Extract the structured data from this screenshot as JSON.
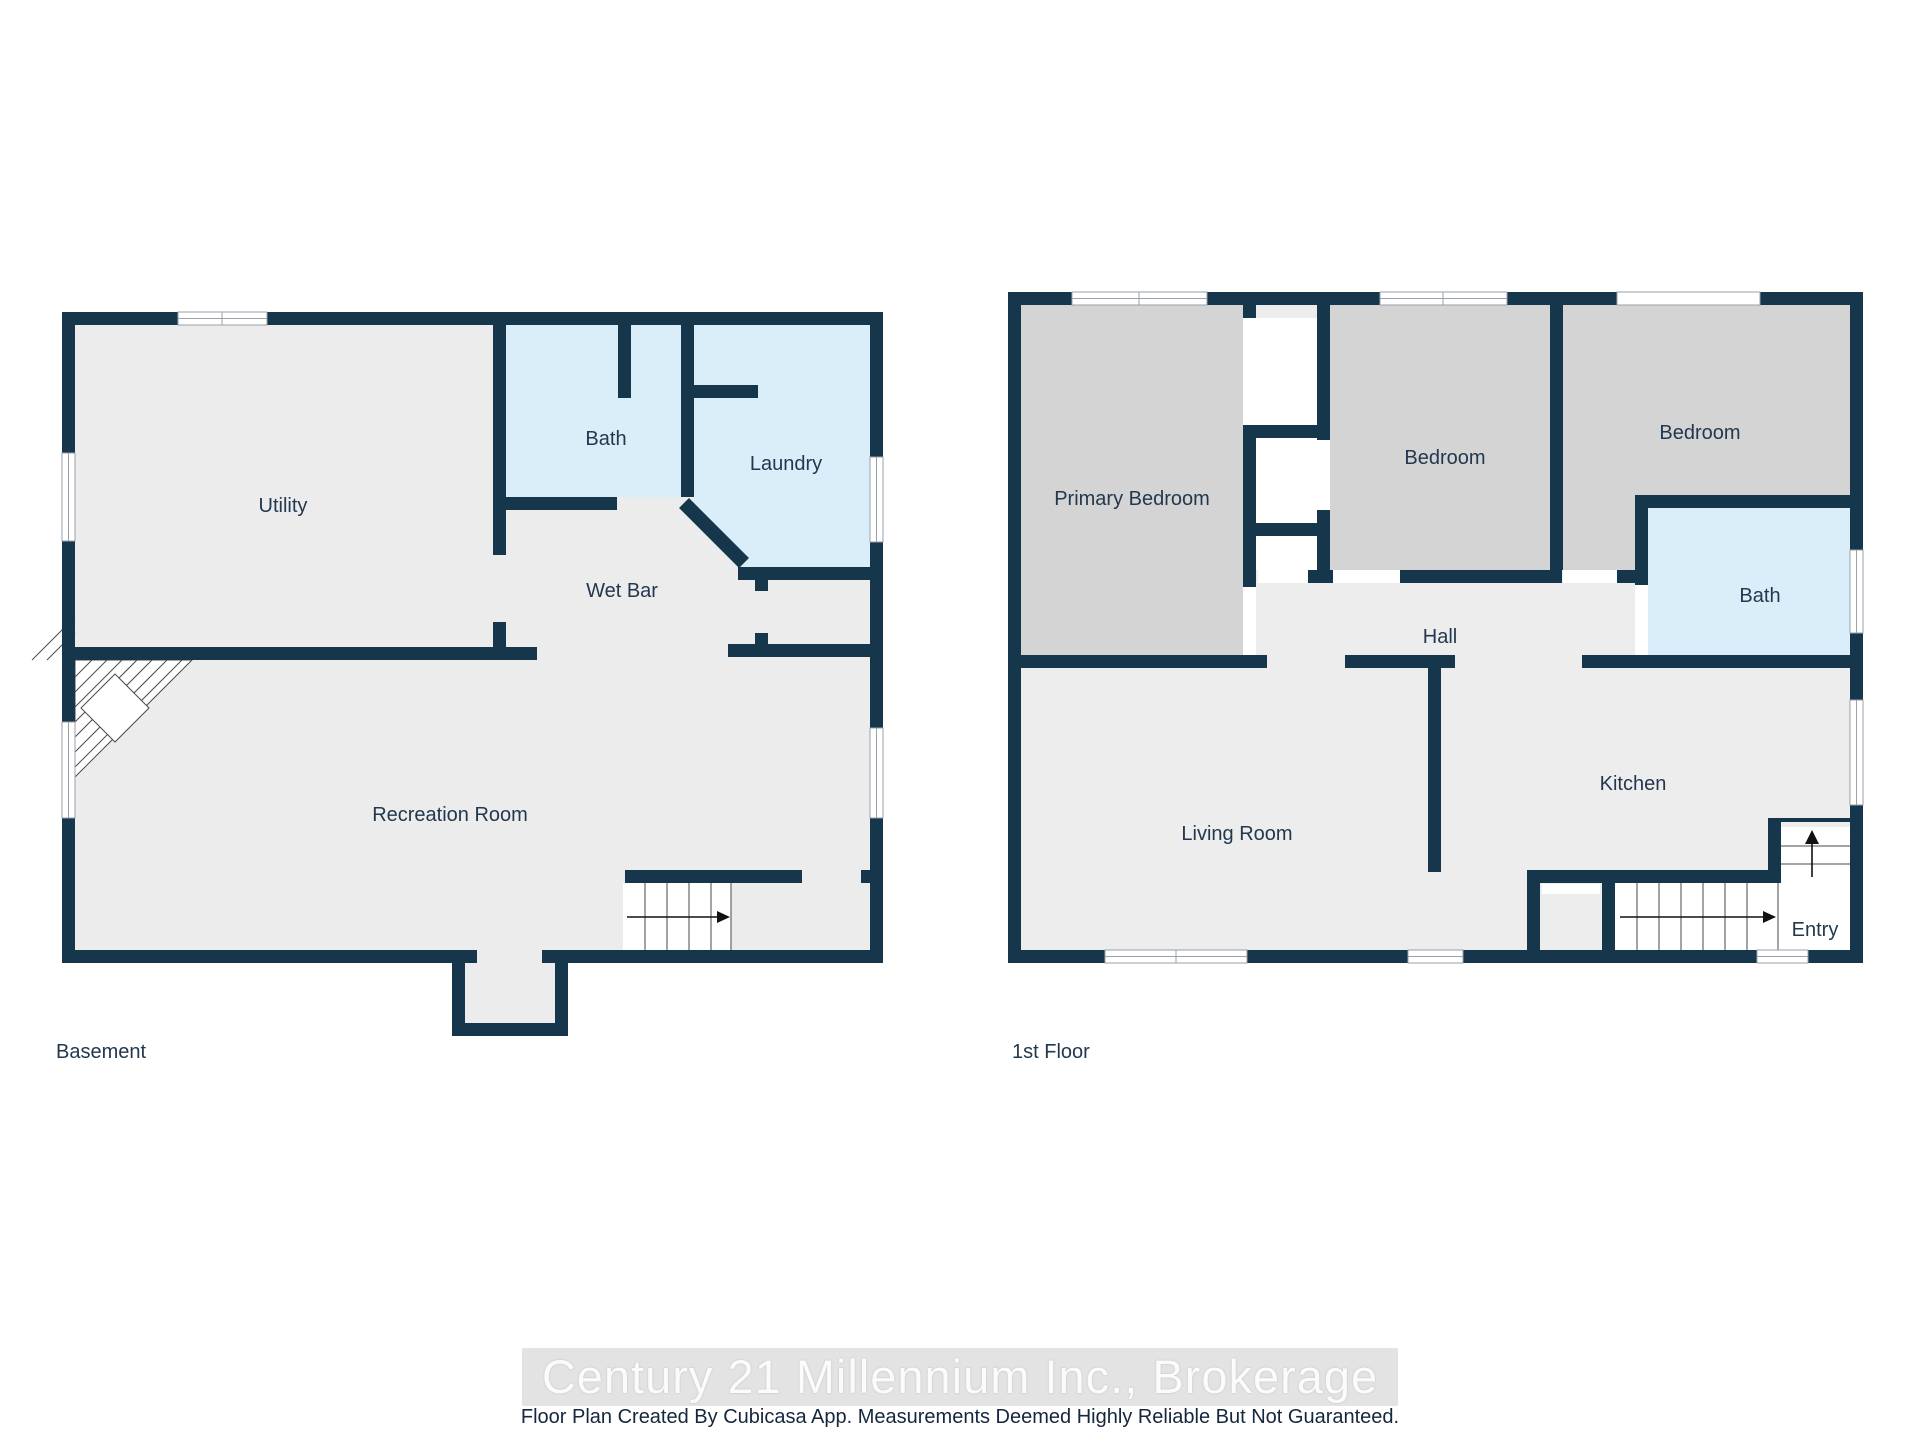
{
  "colors": {
    "wall": "#16364C",
    "basement_floor": "#ECECEC",
    "first_floor_floor": "#EDEDED",
    "bedroom_fill": "#D4D4D4",
    "wet_room_fill": "#DAEEFA",
    "label_text": "#22384E"
  },
  "basement": {
    "label": "Basement",
    "rooms": [
      {
        "label": "Utility"
      },
      {
        "label": "Bath"
      },
      {
        "label": "Laundry"
      },
      {
        "label": "Wet Bar"
      },
      {
        "label": "Recreation Room"
      }
    ]
  },
  "first_floor": {
    "label": "1st Floor",
    "rooms": [
      {
        "label": "Primary Bedroom"
      },
      {
        "label": "Bedroom"
      },
      {
        "label": "Bedroom"
      },
      {
        "label": "Bath"
      },
      {
        "label": "Hall"
      },
      {
        "label": "Living Room"
      },
      {
        "label": "Kitchen"
      },
      {
        "label": "Entry"
      }
    ]
  },
  "footer": {
    "watermark": "Century 21 Millennium Inc., Brokerage",
    "disclaimer": "Floor Plan Created By Cubicasa App. Measurements Deemed Highly Reliable But Not Guaranteed."
  }
}
